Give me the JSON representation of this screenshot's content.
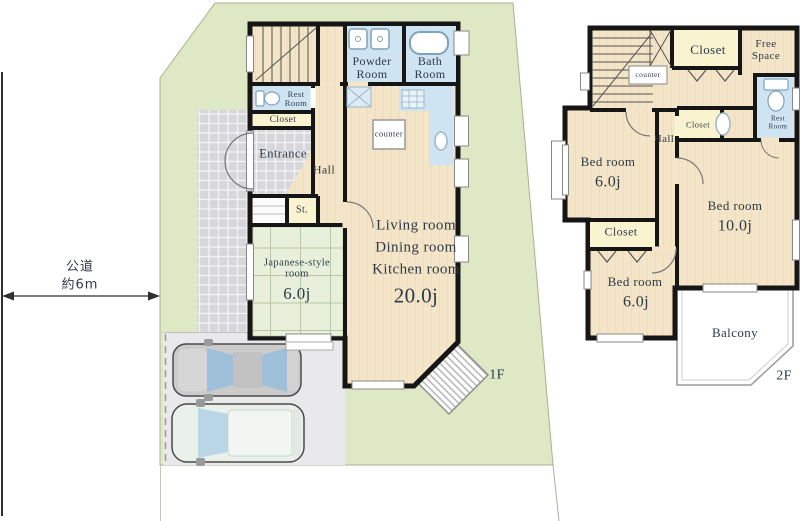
{
  "palette": {
    "wall": "#161616",
    "ink": "#2c3a48",
    "wood_floor": "#f4e5c8",
    "tatami_green": "#e8f0dc",
    "water_blue": "#cfe4f2",
    "closet_yellow": "#faf3cf",
    "lot_green": "#dfe8c4",
    "parking_grey": "#e9e9ec",
    "tile_grey": "#d7d7db"
  },
  "site": {
    "road_label": {
      "line1": "公道",
      "line2": "約6m"
    }
  },
  "floor1": {
    "floor_tag": "1F",
    "powder_room": {
      "line1": "Powder",
      "line2": "Room"
    },
    "bath_room": {
      "line1": "Bath",
      "line2": "Room"
    },
    "rest_room": {
      "line1": "Rest",
      "line2": "Room"
    },
    "closet": {
      "label": "Closet"
    },
    "entrance": {
      "label": "Entrance"
    },
    "hall": {
      "label": "Hall"
    },
    "kitchen_counter": {
      "label": "counter"
    },
    "storage": {
      "label": "St."
    },
    "japanese_room": {
      "line1": "Japanese-style",
      "line2": "room",
      "size": "6.0j"
    },
    "ldk": {
      "line1": "Living room",
      "line2": "Dining room",
      "line3": "Kitchen room",
      "size": "20.0j"
    }
  },
  "floor2": {
    "floor_tag": "2F",
    "stair_counter": {
      "label": "counter"
    },
    "closet_top": {
      "label": "Closet"
    },
    "free_space": {
      "line1": "Free",
      "line2": "Space"
    },
    "rest_room": {
      "line1": "Rest",
      "line2": "Room"
    },
    "hall": {
      "label": "Hall"
    },
    "closet_mid": {
      "label": "Closet"
    },
    "bedroom_left": {
      "label": "Bed room",
      "size": "6.0j"
    },
    "bedroom_right": {
      "label": "Bed room",
      "size": "10.0j"
    },
    "closet_bottom": {
      "label": "Closet"
    },
    "bedroom_bottom": {
      "label": "Bed room",
      "size": "6.0j"
    },
    "balcony": {
      "label": "Balcony"
    }
  }
}
